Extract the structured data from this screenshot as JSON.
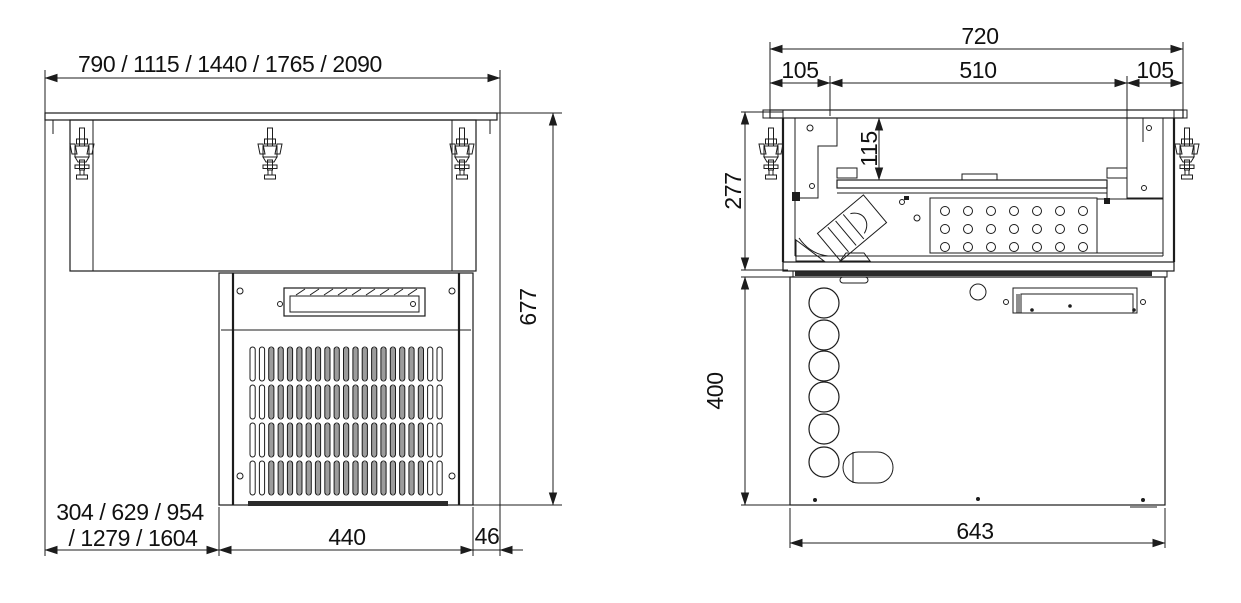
{
  "drawing": {
    "background": "#ffffff",
    "line_color": "#1c1c1c",
    "front_view": {
      "dim_width_variants": "790 / 1115 / 1440 / 1765 / 2090",
      "dim_height": "677",
      "dim_offset_line1": "304 / 629 / 954",
      "dim_offset_line2": "/ 1279 / 1604",
      "dim_unit_width": "440",
      "dim_gap": "46"
    },
    "side_view": {
      "dim_total": "720",
      "dim_front": "105",
      "dim_middle": "510",
      "dim_back": "105",
      "dim_upper_height": "277",
      "dim_inner_height": "115",
      "dim_lower_height": "400",
      "dim_bottom": "643"
    }
  }
}
